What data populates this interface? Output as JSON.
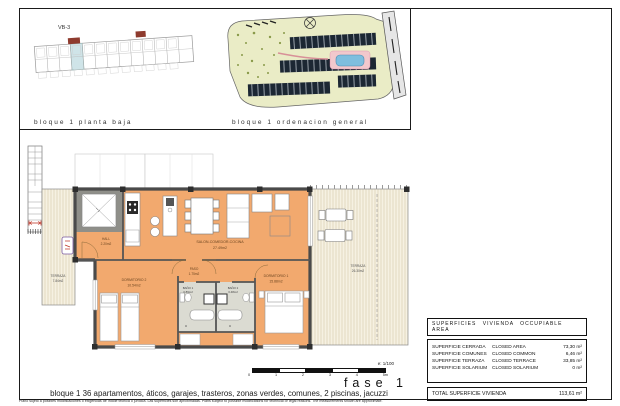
{
  "colors": {
    "room_fill": "#F2A96E",
    "bath_fill": "#DBDBD2",
    "wall": "#4A4A4A",
    "terrace_bg": "#F6F1E2",
    "terrace_stripe": "#DDD3B8",
    "highlight_unit": "#CFE4E8",
    "site_green": "#EAECC6",
    "pool_blue": "#7FBEDE",
    "accent_red": "#8E3B2E"
  },
  "panel_planta": {
    "label": "bloque 1 planta baja",
    "unit_tag": "VB-3"
  },
  "panel_ordenacion": {
    "label": "bloque 1 ordenacion general"
  },
  "rooms": {
    "hall": {
      "name": "HALL",
      "area": "2.20m2"
    },
    "salon": {
      "name": "SALON-COMEDOR-COCINA",
      "area": "27.49m2"
    },
    "paso": {
      "name": "PASO",
      "area": "1.75m2"
    },
    "dorm2": {
      "name": "DORMITORIO 2",
      "area": "10.54m2"
    },
    "dorm1": {
      "name": "DORMITORIO 1",
      "area": "15.88m2"
    },
    "bano1": {
      "name": "BAÑO 1",
      "area": "3.89m2"
    },
    "bano2": {
      "name": "BAÑO 2",
      "area": "3.48m2"
    },
    "terraza_izq": {
      "name": "TERRAZA",
      "area": "7.84m2"
    },
    "terraza_der": {
      "name": "TERRAZA",
      "area": "26.30m2"
    }
  },
  "areas_table": {
    "title": "SUPERFICIES VIVIENDA OCCUPIABLE AREA",
    "rows": [
      {
        "es": "SUPERFICIE CERRADA",
        "en": "CLOSED AREA",
        "value": "73,30 m²"
      },
      {
        "es": "SUPERFICIE COMUNES",
        "en": "CLOSED COMMON",
        "value": "6,46 m²"
      },
      {
        "es": "SUPERFICIE TERRAZA",
        "en": "CLOSED TERRACE",
        "value": "33,85 m²"
      },
      {
        "es": "SUPERFICIE SOLARIUM",
        "en": "CLOSED SOLARIUM",
        "value": "0 m²"
      }
    ],
    "total_label": "TOTAL SUPERFICIE VIVIENDA",
    "total_value": "113,61 m²"
  },
  "footer": {
    "scale_label": "e: 1/100",
    "ticks": [
      "0",
      "1",
      "2",
      "3",
      "4",
      "5m"
    ],
    "fase": "fase 1",
    "bloque_line": "bloque 1   36 apartamentos, áticos, garajes, trasteros, zonas verdes, comunes, 2 piscinas, jacuzzi",
    "disclaimer": "Plano sujeto a posibles modificaciones o exigencias de índole técnica o jurídica. Las superficies son aproximadas. Plans subject to possible modifications for technical or legal reasons. The measurements shown are approximate."
  }
}
